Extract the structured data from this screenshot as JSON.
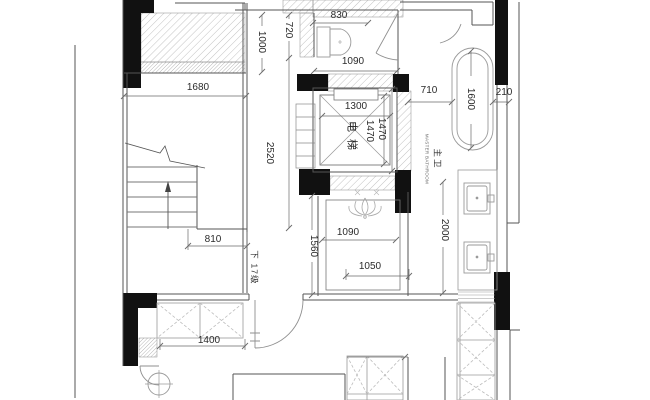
{
  "title": "residential-floor-plan",
  "labels": {
    "elevator": "电梯",
    "master_bath_cn": "主卫",
    "master_bath_en": "MASTER BATHROOM",
    "stairs_down": "下",
    "stairs_steps": "17级"
  },
  "dimensions": {
    "d1680": "1680",
    "d830": "830",
    "d1000": "1000",
    "d720": "720",
    "d2520": "2520",
    "d1090_top": "1090",
    "d1300": "1300",
    "d1470_inner": "1470",
    "d1470_outer": "1470",
    "d710": "710",
    "d1600": "1600",
    "d210": "210",
    "d810": "810",
    "d1560": "1560",
    "d1090_room": "1090",
    "d2000": "2000",
    "d1050": "1050",
    "d1400": "1400"
  },
  "colors": {
    "background": "#ffffff",
    "wall_fill": "#111111",
    "wall_line": "#555555",
    "dim_line": "#6b6b6b",
    "furniture_line": "#9a9a9a",
    "hatch_line": "#b3b3b3",
    "text": "#2b2b2b"
  }
}
